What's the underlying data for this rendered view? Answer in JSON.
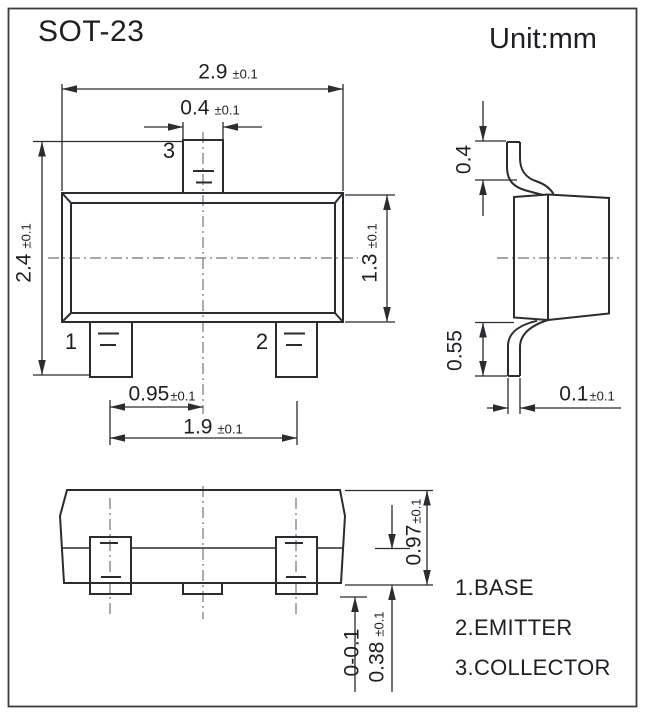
{
  "header": {
    "title": "SOT-23",
    "unit": "Unit:mm"
  },
  "pins": {
    "p1": "1",
    "p2": "2",
    "p3": "3"
  },
  "dims": {
    "body_width": {
      "value": "2.9",
      "tol": "±0.1"
    },
    "pin_width": {
      "value": "0.4",
      "tol": "±0.1"
    },
    "overall_depth": {
      "value": "2.4",
      "tol": "±0.1"
    },
    "body_depth": {
      "value": "1.3",
      "tol": "±0.1"
    },
    "pin_pitch": {
      "value": "0.95",
      "tol": "±0.1"
    },
    "pin_span": {
      "value": "1.9",
      "tol": "±0.1"
    },
    "lead_top_height": {
      "value": "0.4",
      "tol": ""
    },
    "lead_bottom_height": {
      "value": "0.55",
      "tol": ""
    },
    "lead_thickness": {
      "value": "0.1",
      "tol": "±0.1"
    },
    "package_height": {
      "value": "0.97",
      "tol": "±0.1"
    },
    "body_thickness": {
      "value": "0.38",
      "tol": "±0.1"
    },
    "standoff": {
      "value": "0-0.1",
      "tol": ""
    }
  },
  "legend": {
    "items": [
      "1.BASE",
      "2.EMITTER",
      "3.COLLECTOR"
    ]
  },
  "colors": {
    "line": "#2b2b31",
    "centerline": "#73737a",
    "text": "#1e1e24",
    "background": "#ffffff"
  }
}
